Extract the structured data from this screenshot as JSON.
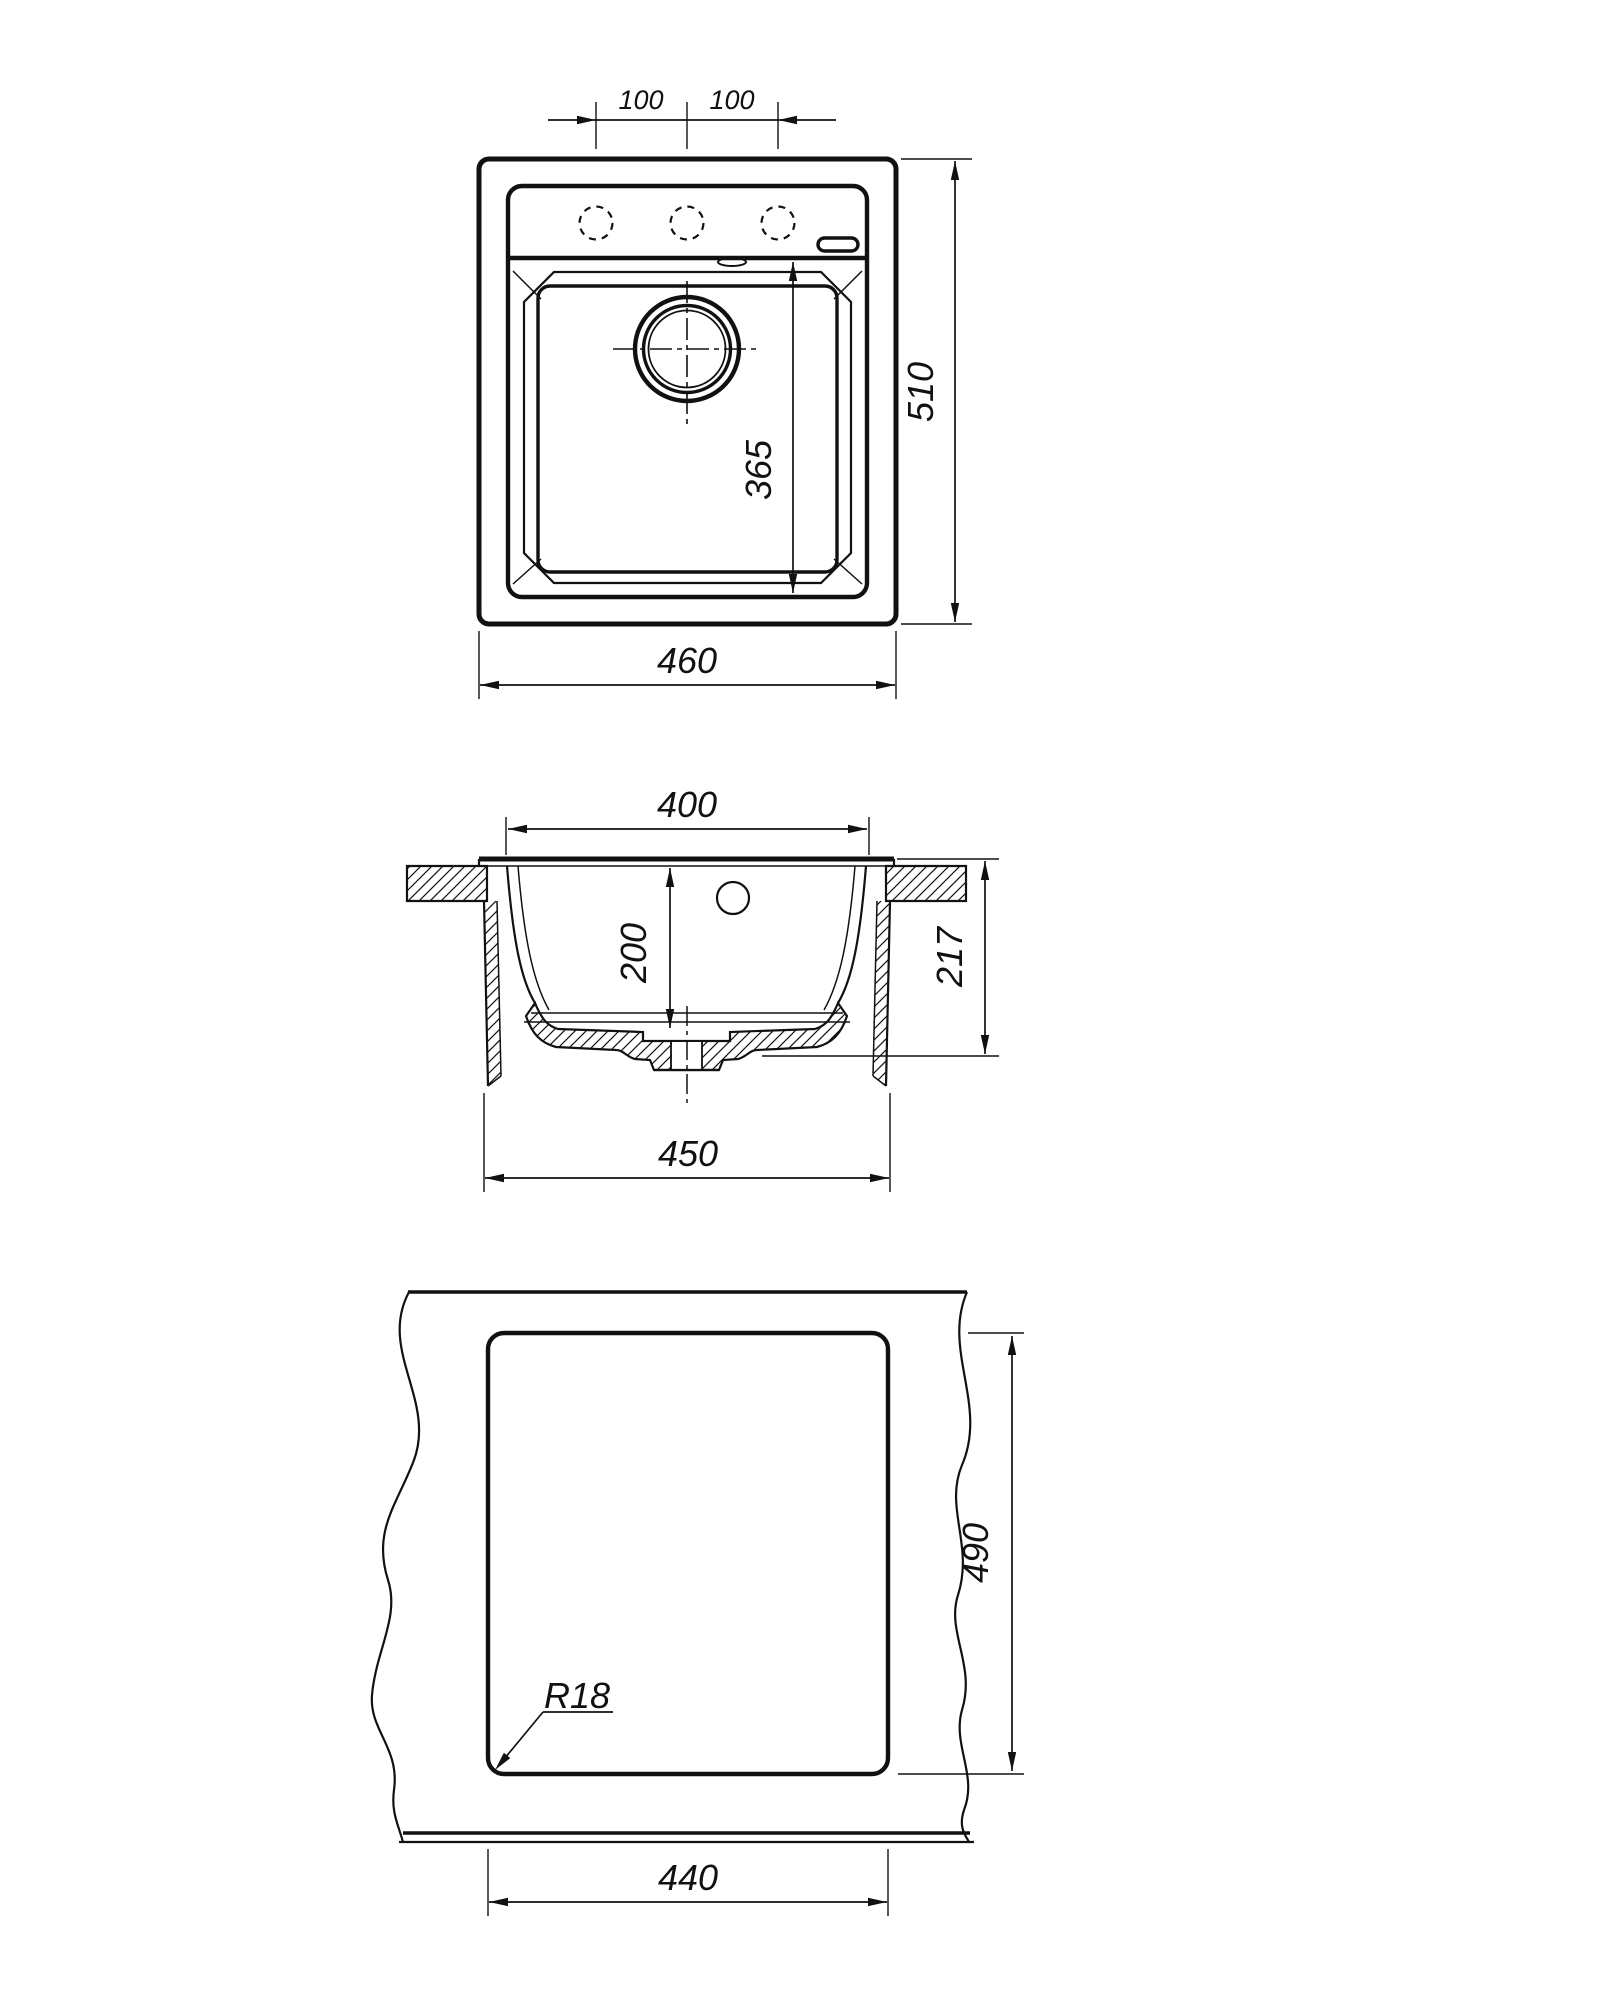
{
  "drawing": {
    "background": "#ffffff",
    "line_color": "#111111",
    "views": {
      "top_view": {
        "hole_spacing_left": "100",
        "hole_spacing_right": "100",
        "overall_width": "460",
        "overall_depth": "510",
        "bowl_inner_length": "365"
      },
      "section_view": {
        "bowl_top_width": "400",
        "bowl_depth": "200",
        "overall_height": "217",
        "underside_width": "450"
      },
      "cutout_view": {
        "cutout_width": "440",
        "cutout_height": "490",
        "corner_radius_label": "R18"
      }
    }
  }
}
